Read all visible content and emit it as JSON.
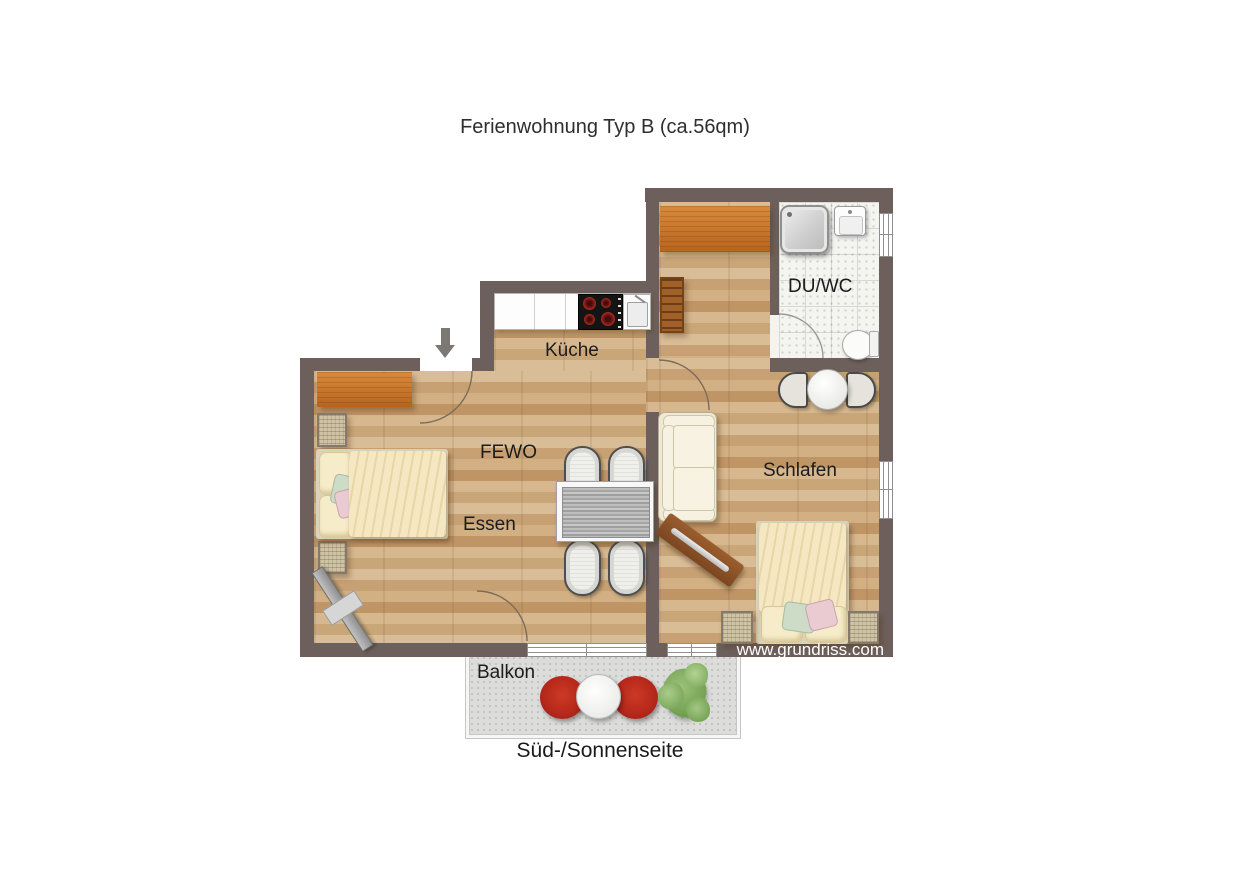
{
  "title": "Ferienwohnung Typ B (ca.56qm)",
  "rooms": {
    "kitchen": "Küche",
    "living": "FEWO",
    "dining": "Essen",
    "bedroom": "Schlafen",
    "bath": "DU/WC",
    "balcony": "Balkon"
  },
  "labels": {
    "south": "Süd-/Sonnenseite",
    "watermark": "www.grundriss.com"
  },
  "icons": {
    "entrance_arrow": "down-arrow"
  },
  "colors": {
    "wall": "#6d605c",
    "wood_floor": "#cfab80",
    "tile_floor": "#f4f4f1",
    "balcony_floor": "#dcdcda",
    "wardrobe_orange": "#c8752c",
    "red_chair": "#b5271b",
    "plant_green": "#7fae5e",
    "bedding_cream": "#f4e7c1"
  }
}
